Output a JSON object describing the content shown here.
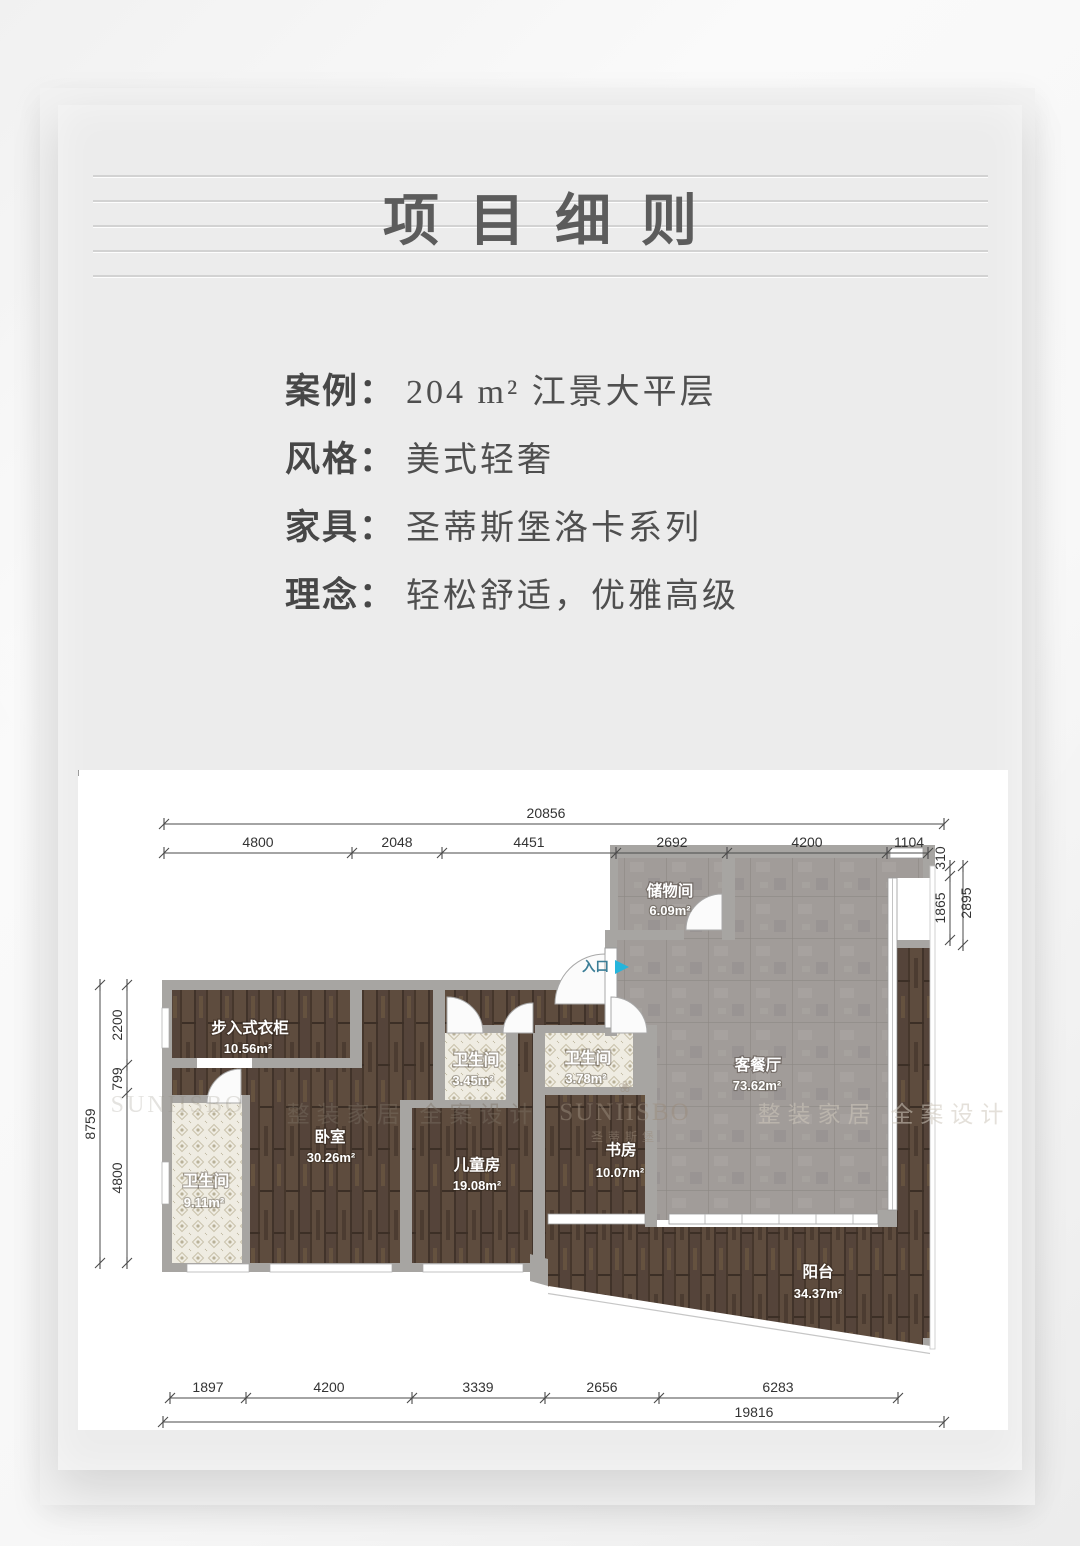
{
  "page": {
    "title": "项目细则"
  },
  "info": {
    "items": [
      {
        "label": "案例：",
        "value": "204 m² 江景大平层"
      },
      {
        "label": "风格：",
        "value": "美式轻奢"
      },
      {
        "label": "家具：",
        "value": "圣蒂斯堡洛卡系列"
      },
      {
        "label": "理念：",
        "value": "轻松舒适，优雅高级"
      }
    ]
  },
  "floorplan": {
    "entrance_label": "入口",
    "rooms": [
      {
        "name": "储物间",
        "area": "6.09m²"
      },
      {
        "name": "步入式衣柜",
        "area": "10.56m²"
      },
      {
        "name": "卫生间",
        "area": "3.45m²"
      },
      {
        "name": "卫生间",
        "area": "3.78m²"
      },
      {
        "name": "客餐厅",
        "area": "73.62m²"
      },
      {
        "name": "卧室",
        "area": "30.26m²"
      },
      {
        "name": "儿童房",
        "area": "19.08m²"
      },
      {
        "name": "书房",
        "area": "10.07m²"
      },
      {
        "name": "卫生间",
        "area": "9.11m²"
      },
      {
        "name": "阳台",
        "area": "34.37m²"
      }
    ],
    "dims": {
      "top": {
        "total": "20856",
        "segments": [
          "4800",
          "2048",
          "4451",
          "2692",
          "4200",
          "1104"
        ]
      },
      "bottom": {
        "total": "19816",
        "segments": [
          "1897",
          "4200",
          "3339",
          "2656",
          "6283"
        ]
      },
      "left": {
        "total": "8759",
        "segments": [
          "2200",
          "799",
          "4800"
        ]
      },
      "right": {
        "total": "2895",
        "segments": [
          "310",
          "1865"
        ]
      }
    },
    "watermarks": {
      "brand": "SUNIISBO",
      "brand_cn": "圣蒂斯堡",
      "slogan": "整装家居 全案设计",
      "flower": "❀"
    },
    "colors": {
      "wood": "#55443a",
      "tile": "#a19c99",
      "mosaic": "#efece2",
      "wall": "#a7a5a2",
      "entrance_accent": "#25b5dc"
    }
  }
}
